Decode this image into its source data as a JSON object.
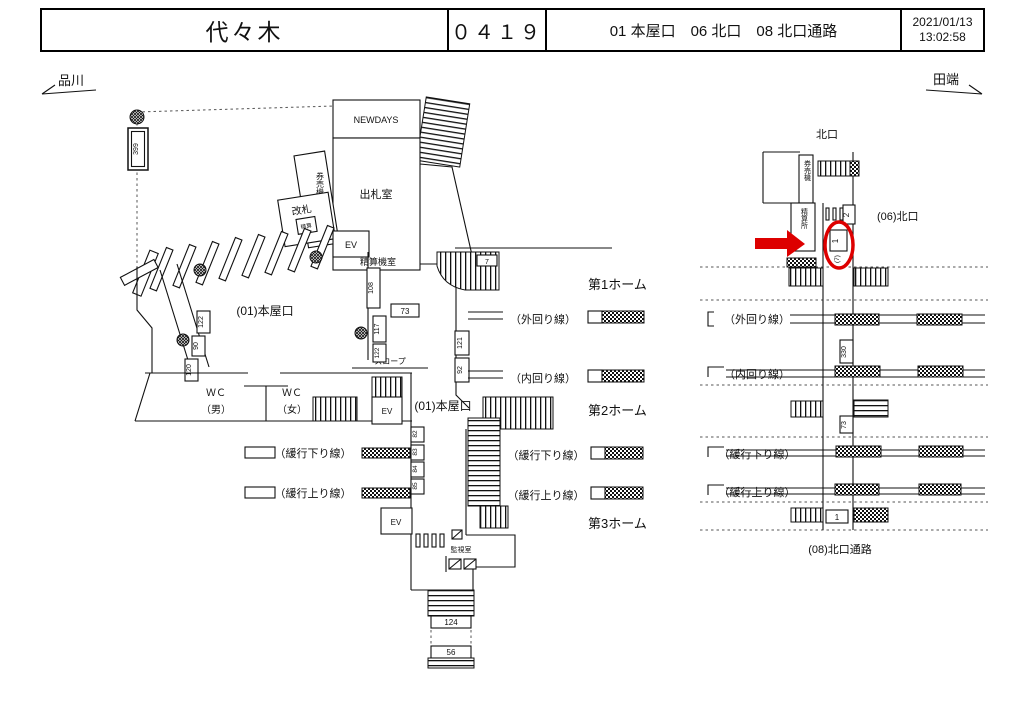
{
  "colors": {
    "highlight": "#dd0000"
  },
  "header": {
    "station_name": "代々木",
    "station_code": "０４１９",
    "locations": "01 本屋口　06 北口　08 北口通路",
    "date": "2021/01/13",
    "time": "13:02:58"
  },
  "nav": {
    "left_station": "品川",
    "right_station": "田端"
  },
  "lines": {
    "outer": "（外回り線）",
    "inner": "（内回り線）",
    "local_down": "（緩行下り線）",
    "local_up": "（緩行上り線）"
  },
  "platforms": {
    "p1": "第1ホーム",
    "p2": "第2ホーム",
    "p3": "第3ホーム"
  },
  "left_map": {
    "shop": "NEWDAYS",
    "ticket_office": "出札室",
    "ticket_machines": "券売機",
    "gate": "改札",
    "gate_machine": "精算",
    "fare_machine_room": "精算機室",
    "elevator": "EV",
    "exit_01": "(01)本屋口",
    "wc": "ＷＣ",
    "wc_male": "（男）",
    "wc_female": "（女）",
    "slope": "スロープ",
    "monitor_room": "監視室",
    "pos_numbers": {
      "n399": "399",
      "n122a": "122",
      "n90": "90",
      "n120": "120",
      "n108": "108",
      "n73": "73",
      "n117": "117",
      "n122b": "122",
      "n121": "121",
      "n92": "92",
      "n7": "7",
      "n82": "82",
      "n83": "83",
      "n84": "84",
      "n85": "85",
      "n124": "124",
      "n56": "56"
    }
  },
  "right_map": {
    "north_exit": "北口",
    "ticket_machines": "券売機",
    "fare_office": "精算所",
    "exit_06": "(06)北口",
    "exit_08": "(08)北口通路",
    "pos_numbers": {
      "n2": "2",
      "n1": "1",
      "n1_note": "(7)",
      "n330": "330",
      "n73": "73",
      "n1b": "1"
    }
  }
}
